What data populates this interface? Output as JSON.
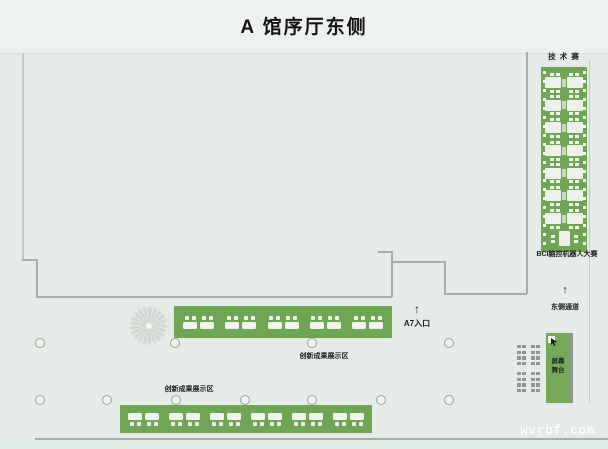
{
  "title": "A 馆序厅东侧",
  "watermark": "wvrbf.com",
  "tech_zone": {
    "label": "技 术 赛",
    "competition_label": "BCI脑控机器人大赛",
    "units": 7
  },
  "east_passage": {
    "arrow": "↑",
    "label": "东侧通道"
  },
  "entrance_a7": {
    "arrow": "↑",
    "label": "A7入口"
  },
  "display_zone_upper": {
    "label": "创新成果展示区",
    "table_pairs": 5
  },
  "display_zone_lower": {
    "label": "创新成果展示区",
    "table_pairs": 6
  },
  "stage": {
    "label": "屏幕舞台",
    "line1": "屏幕",
    "line2": "舞台"
  },
  "colors": {
    "booth_green": "#6fa653",
    "table_white": "#f2f4ee",
    "wall_gray": "#a6aeaa",
    "background": "#e5ece7",
    "seat_gray": "#8f948f"
  }
}
